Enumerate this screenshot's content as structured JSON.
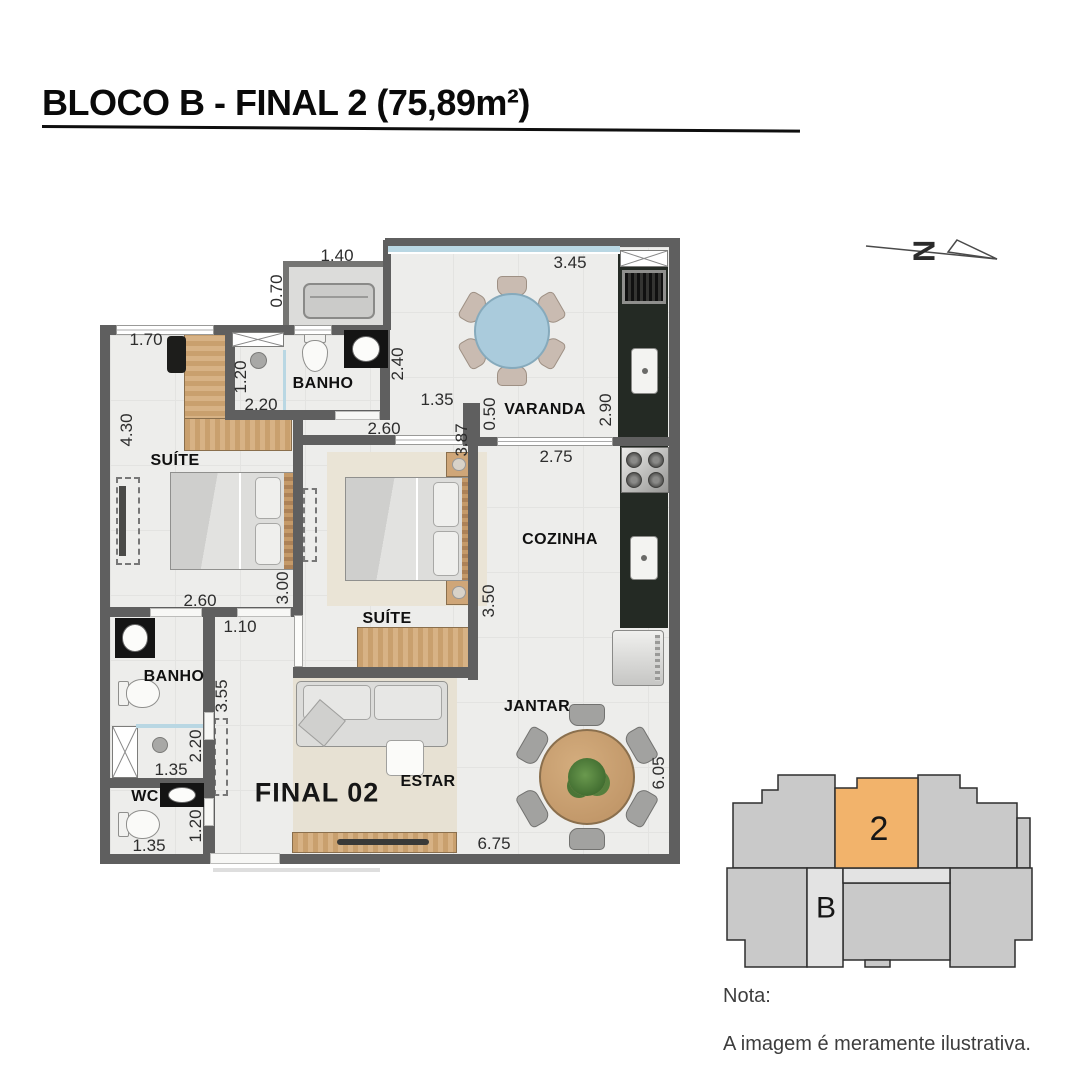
{
  "title": "BLOCO B - FINAL 2 (75,89m²)",
  "north": {
    "label": "N"
  },
  "plan": {
    "unit_label": "FINAL 02",
    "rooms": [
      {
        "label": "SUÍTE"
      },
      {
        "label": "BANHO"
      },
      {
        "label": "VARANDA"
      },
      {
        "label": "SUÍTE"
      },
      {
        "label": "COZINHA"
      },
      {
        "label": "BANHO"
      },
      {
        "label": "WC"
      },
      {
        "label": "ESTAR"
      },
      {
        "label": "JANTAR"
      }
    ],
    "dimensions": [
      {
        "text": "1.40"
      },
      {
        "text": "0.70"
      },
      {
        "text": "3.45"
      },
      {
        "text": "1.70"
      },
      {
        "text": "1.20"
      },
      {
        "text": "2.20"
      },
      {
        "text": "2.40"
      },
      {
        "text": "1.35"
      },
      {
        "text": "0.50"
      },
      {
        "text": "2.90"
      },
      {
        "text": "2.75"
      },
      {
        "text": "3.87"
      },
      {
        "text": "2.60"
      },
      {
        "text": "4.30"
      },
      {
        "text": "3.00"
      },
      {
        "text": "2.60"
      },
      {
        "text": "1.10"
      },
      {
        "text": "3.50"
      },
      {
        "text": "3.55"
      },
      {
        "text": "2.20"
      },
      {
        "text": "1.35"
      },
      {
        "text": "1.20"
      },
      {
        "text": "1.35"
      },
      {
        "text": "6.75"
      },
      {
        "text": "6.05"
      }
    ]
  },
  "keyplan": {
    "unit_number": "2",
    "block_letter": "B",
    "highlight_color": "#f2b36b"
  },
  "note": {
    "label": "Nota:",
    "text": "A imagem é meramente ilustrativa."
  },
  "colors": {
    "wall": "#5f5f5f",
    "floor": "#ededeb",
    "wood": "#c9a06e",
    "counter_dark": "#242a24",
    "glass": "#b9d7e3",
    "rug": "#e7e1d3",
    "keyplan_gray": "#c9c9c9"
  }
}
